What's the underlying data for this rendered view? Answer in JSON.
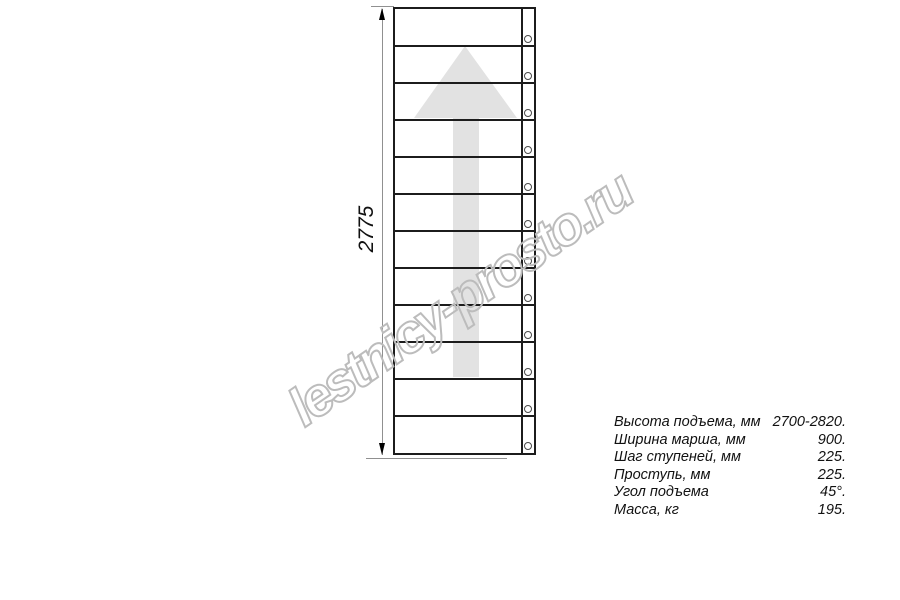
{
  "watermark": {
    "text": "lestnicy-prosto.ru",
    "stroke_color": "#bcbcbc"
  },
  "drawing": {
    "type": "staircase-plan-top-view",
    "dimension_label": "2775",
    "steps_count": 12,
    "bolts_count": 12,
    "direction_arrow": "up",
    "arrow_color": "#e2e2e2",
    "line_color": "#1c1c1c"
  },
  "specs": {
    "rows": [
      {
        "label": "Высота подъема, мм",
        "value": "2700-2820."
      },
      {
        "label": "Ширина марша, мм",
        "value": "900."
      },
      {
        "label": "Шаг ступеней, мм",
        "value": "225."
      },
      {
        "label": "Проступь, мм",
        "value": "225."
      },
      {
        "label": "Угол подъема",
        "value": "45°."
      },
      {
        "label": "Масса, кг",
        "value": "195."
      }
    ]
  }
}
